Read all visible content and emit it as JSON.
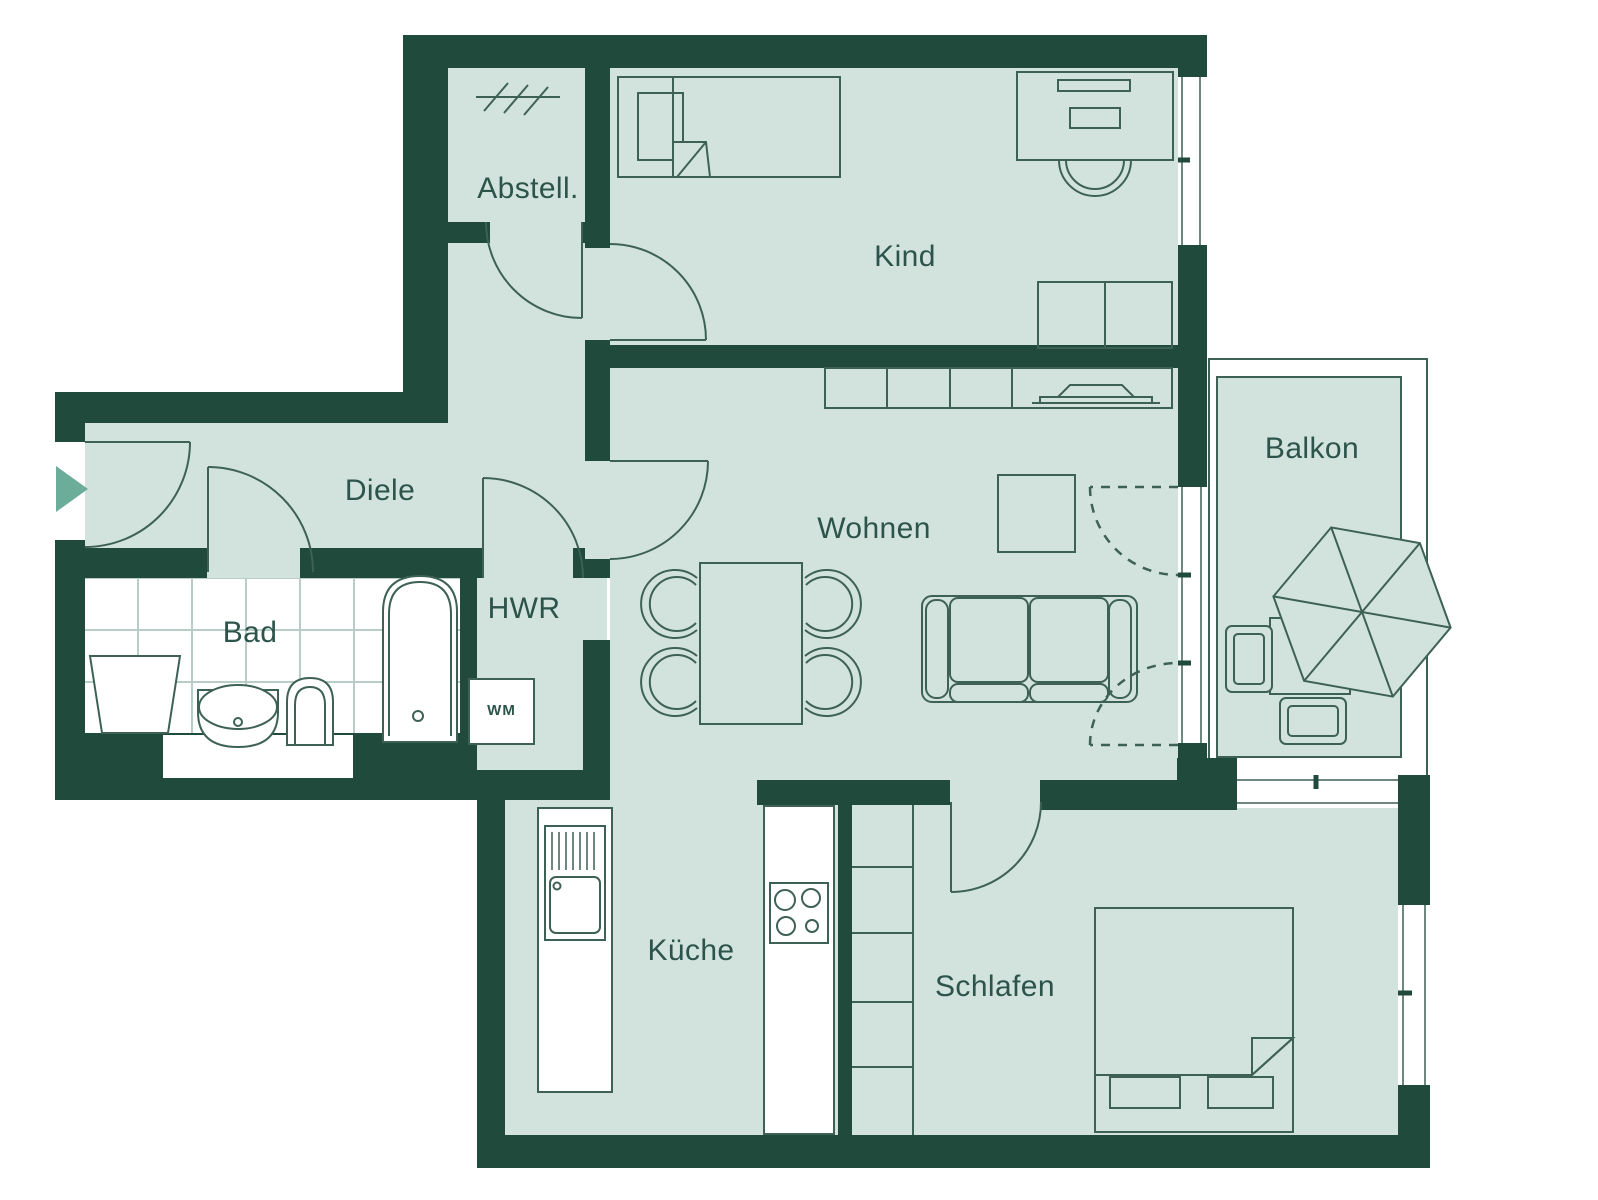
{
  "plan": {
    "type": "apartment-floor-plan",
    "rooms": [
      {
        "id": "abstell",
        "label": "Abstell."
      },
      {
        "id": "kind",
        "label": "Kind"
      },
      {
        "id": "diele",
        "label": "Diele"
      },
      {
        "id": "bad",
        "label": "Bad"
      },
      {
        "id": "hwr",
        "label": "HWR"
      },
      {
        "id": "wohnen",
        "label": "Wohnen"
      },
      {
        "id": "balkon",
        "label": "Balkon"
      },
      {
        "id": "kueche",
        "label": "Küche"
      },
      {
        "id": "schlafen",
        "label": "Schlafen"
      }
    ],
    "appliances": {
      "washing_machine_label": "WM"
    },
    "colors": {
      "wall": "#1F4A3C",
      "floor": "#D2E3DD",
      "outline": "#3E6156",
      "label": "#2C544A",
      "entry_arrow": "#6CAD9A",
      "tile_line": "#B7CDC6",
      "bg": "#FFFFFF"
    }
  }
}
